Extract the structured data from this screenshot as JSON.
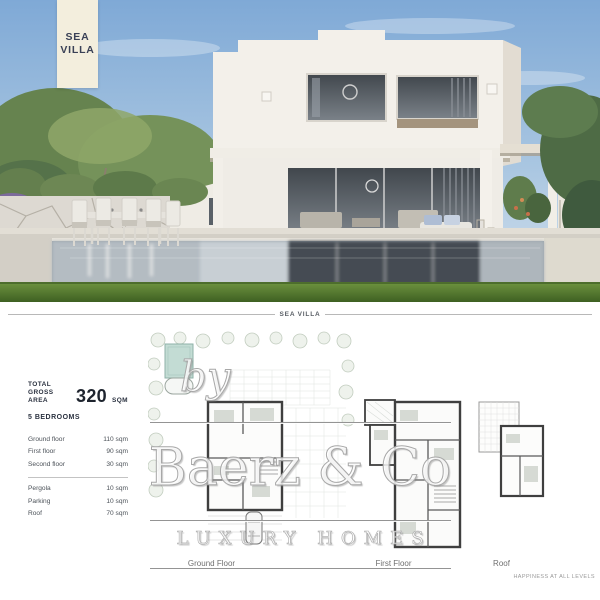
{
  "banner": {
    "line1": "SEA",
    "line2": "VILLA"
  },
  "section_divider": {
    "title": "SEA VILLA"
  },
  "info": {
    "total_label_line1": "TOTAL",
    "total_label_line2": "GROSS AREA",
    "total_value": "320",
    "total_unit": "SQM",
    "bedrooms": "5 BEDROOMS",
    "floors": [
      {
        "label": "Ground floor",
        "value": "110 sqm"
      },
      {
        "label": "First floor",
        "value": "90 sqm"
      },
      {
        "label": "Second floor",
        "value": "30 sqm"
      }
    ],
    "extras": [
      {
        "label": "Pergola",
        "value": "10 sqm"
      },
      {
        "label": "Parking",
        "value": "10 sqm"
      },
      {
        "label": "Roof",
        "value": "70 sqm"
      }
    ]
  },
  "plan_labels": [
    "Ground Floor",
    "First Floor",
    "Roof"
  ],
  "watermark": {
    "by": "by",
    "brand": "Baerz & Co",
    "tagline": "LUXURY HOMES"
  },
  "footer_slogan": "HAPPINESS AT ALL LEVELS",
  "colors": {
    "banner_bg": "#f3eedd",
    "banner_text": "#3a4156",
    "plan_pool_fill": "#c3dcd4",
    "divider_line": "#b8b8b8",
    "grass_green": "#5d8a33",
    "sky_blue": "#7fa9d6"
  }
}
